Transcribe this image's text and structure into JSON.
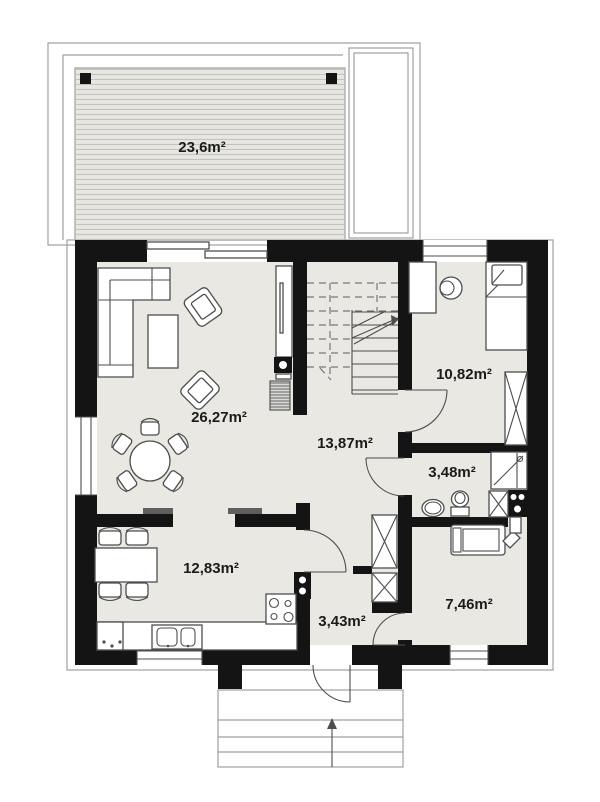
{
  "plan_title": "floor-plan",
  "rooms": {
    "terrace": {
      "label": "23,6m²"
    },
    "living": {
      "label": "26,27m²"
    },
    "hall": {
      "label": "13,87m²"
    },
    "bedroom": {
      "label": "10,82m²"
    },
    "bathroom": {
      "label": "3,48m²"
    },
    "kitchen": {
      "label": "12,83m²"
    },
    "entry": {
      "label": "3,43m²"
    },
    "utility": {
      "label": "7,46m²"
    }
  },
  "colors": {
    "wall": "#141414",
    "floor": "#e9e8e2",
    "deck": "#e7e6e1",
    "furniture_line": "#4d4d4d",
    "roof_outline": "#9f9f9f"
  }
}
